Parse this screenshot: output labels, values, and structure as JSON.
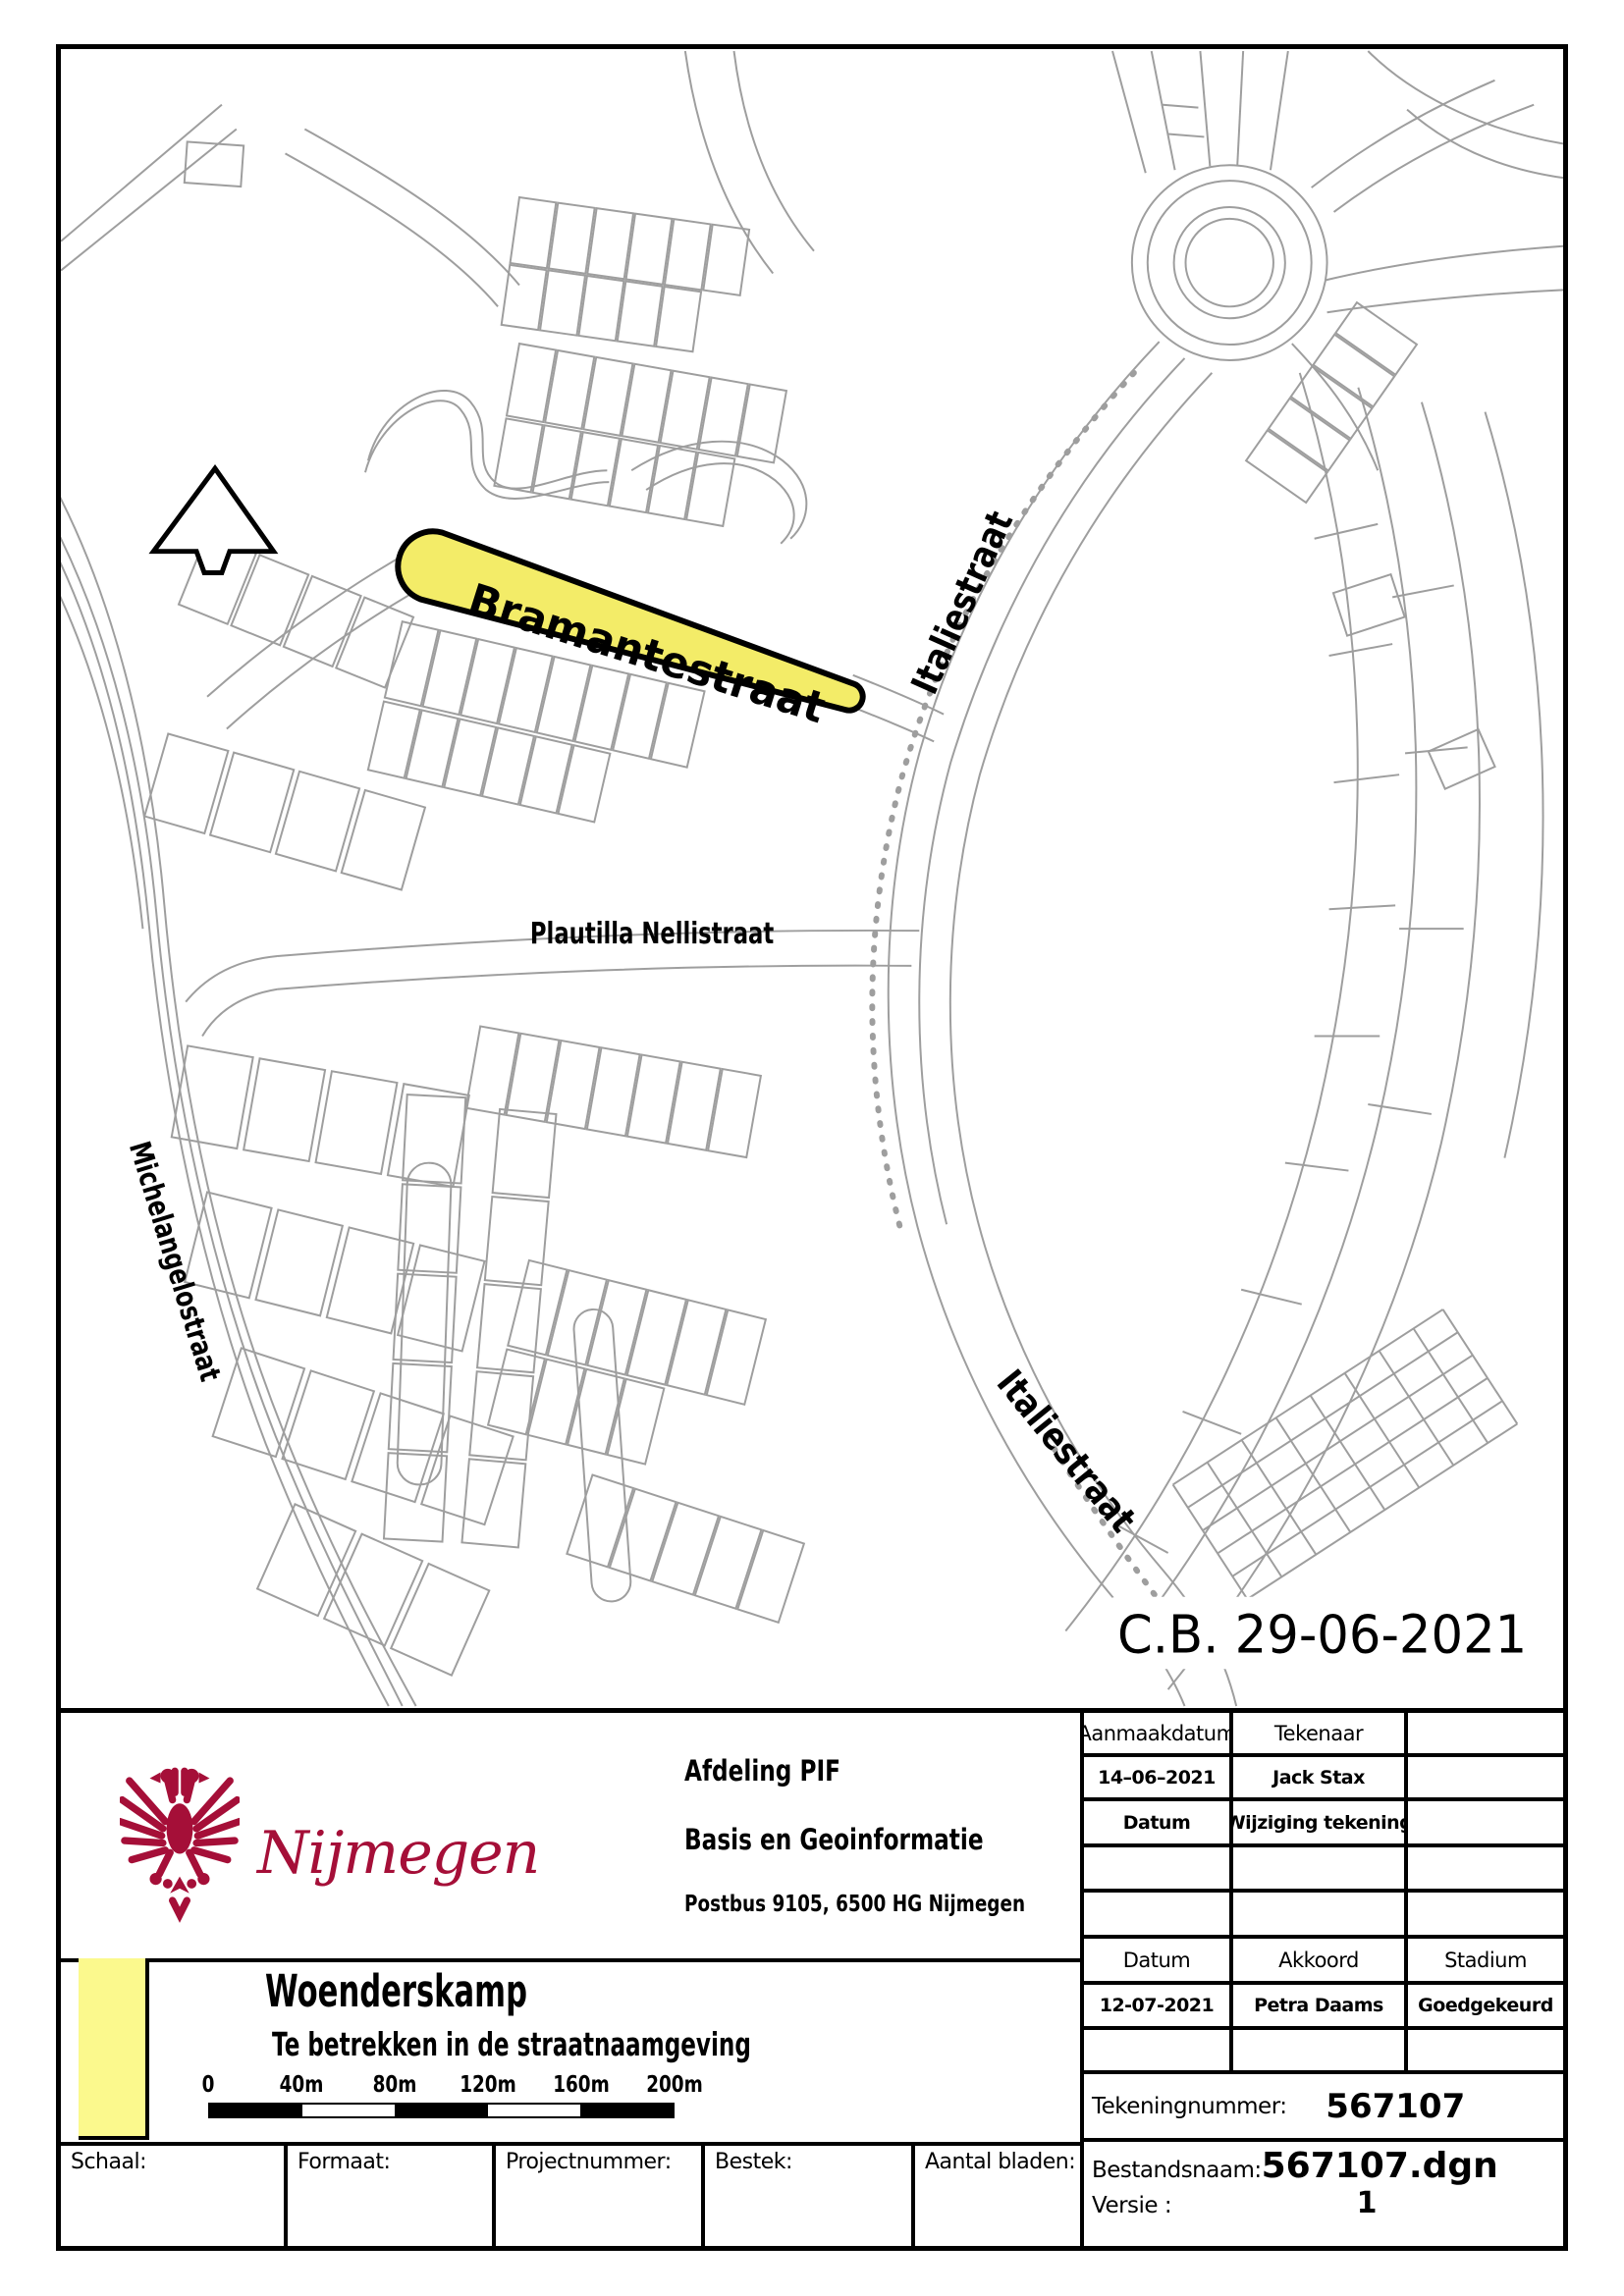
{
  "map": {
    "highlighted_street": "Bramantestraat",
    "street_labels": {
      "italiestraat_top": "Italiestraat",
      "plautilla_nellistraat": "Plautilla Nellistraat",
      "michelangelostraat": "Michelangelostraat",
      "italiestraat_bottom": "Italiestraat"
    },
    "approval_stamp": "C.B. 29-06-2021",
    "highlight_color": "#f3ec68",
    "line_color": "#9e9e9e"
  },
  "title_block": {
    "logo_text": "Nijmegen",
    "brand_color": "#a50f38",
    "department": "Afdeling PIF",
    "unit": "Basis en Geoinformatie",
    "address": "Postbus 9105, 6500 HG  Nijmegen",
    "project_title": "Woenderskamp",
    "project_subtitle": "Te betrekken in de straatnaamgeving",
    "scale_bar": {
      "labels": [
        "0",
        "40m",
        "80m",
        "120m",
        "160m",
        "200m"
      ]
    },
    "revision_table": {
      "rows": [
        [
          "Aanmaakdatum",
          "Tekenaar",
          ""
        ],
        [
          "14–06–2021",
          "Jack Stax",
          ""
        ],
        [
          "Datum",
          "Wijziging tekening",
          ""
        ],
        [
          "",
          "",
          ""
        ],
        [
          "",
          "",
          ""
        ],
        [
          "Datum",
          "Akkoord",
          "Stadium"
        ],
        [
          "12-07-2021",
          "Petra Daams",
          "Goedgekeurd"
        ],
        [
          "",
          "",
          ""
        ]
      ]
    },
    "drawing_number_label": "Tekeningnummer:",
    "drawing_number": "567107",
    "file_name_label": "Bestandsnaam:",
    "file_name": "567107.dgn",
    "version_label": "Versie :",
    "version": "1",
    "bottom_fields": [
      "Schaal:",
      "Formaat:",
      "Projectnummer:",
      "Bestek:",
      "Aantal bladen:"
    ]
  }
}
